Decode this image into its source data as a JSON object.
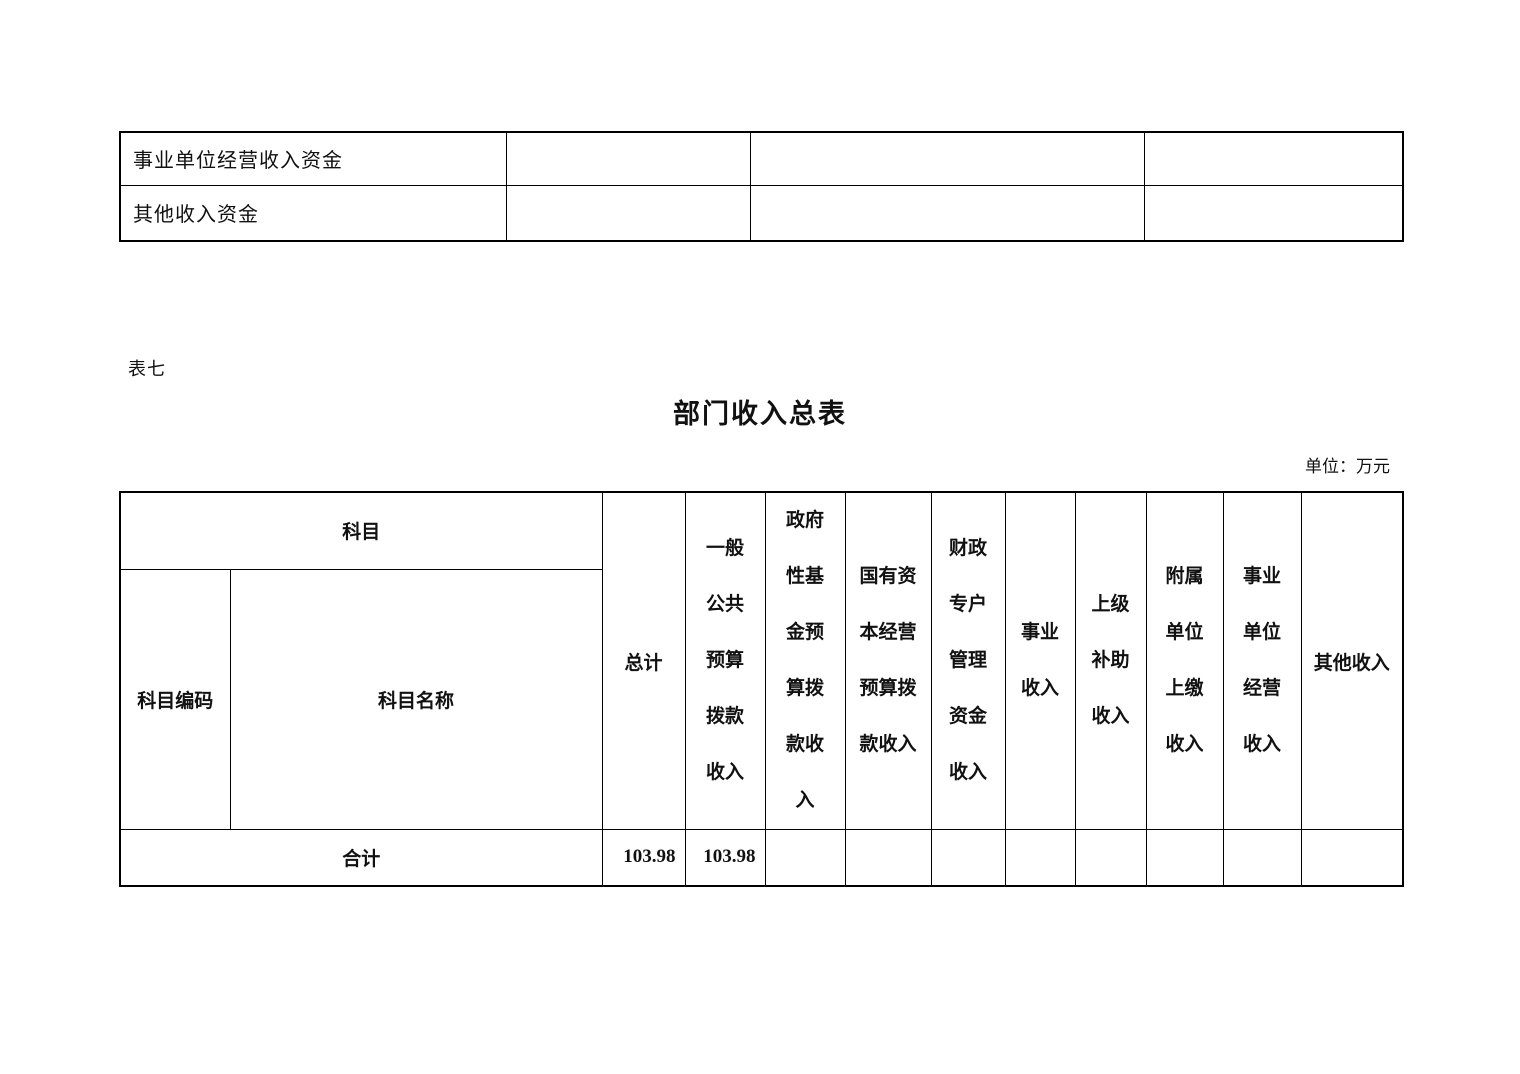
{
  "page": {
    "table_label": "表七",
    "title": "部门收入总表",
    "unit_note": "单位：万元"
  },
  "top_table": {
    "rows": [
      {
        "label": "事业单位经营收入资金",
        "cells": [
          "",
          "",
          ""
        ]
      },
      {
        "label": "其他收入资金",
        "cells": [
          "",
          "",
          ""
        ]
      }
    ]
  },
  "main_table": {
    "header": {
      "subject_group": "科目",
      "subject_code": "科目编码",
      "subject_name": "科目名称",
      "total": "总计",
      "income_columns": [
        {
          "name": "一般公共预算拨款收入",
          "text": "一般\n公共\n预算\n拨款\n收入"
        },
        {
          "name": "政府性基金预算拨款收入",
          "text": "政府\n性基\n金预\n算拨\n款收\n入"
        },
        {
          "name": "国有资本经营预算拨款收入",
          "text": "国有资\n本经营\n预算拨\n款收入"
        },
        {
          "name": "财政专户管理资金收入",
          "text": "财政\n专户\n管理\n资金\n收入"
        },
        {
          "name": "事业收入",
          "text": "事业\n收入"
        },
        {
          "name": "上级补助收入",
          "text": "上级\n补助\n收入"
        },
        {
          "name": "附属单位上缴收入",
          "text": "附属\n单位\n上缴\n收入"
        },
        {
          "name": "事业单位经营收入",
          "text": "事业\n单位\n经营\n收入"
        },
        {
          "name": "其他收入",
          "text": "其他收入"
        }
      ]
    },
    "rows": [
      {
        "label": "合计",
        "cells": [
          "103.98",
          "103.98",
          "",
          "",
          "",
          "",
          "",
          "",
          "",
          ""
        ]
      }
    ]
  }
}
